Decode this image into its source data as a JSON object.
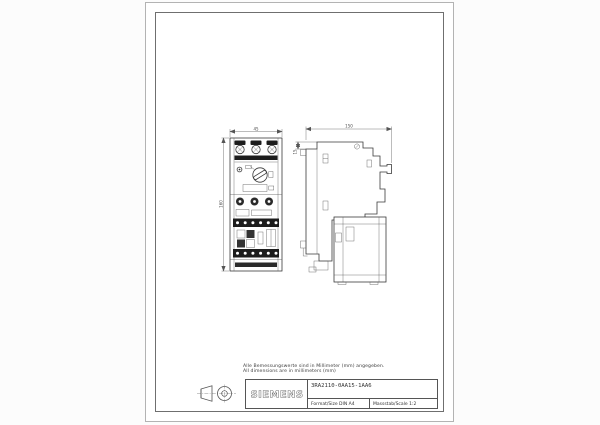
{
  "sheet": {
    "notes": {
      "line1": "Alle Bemessungswerte sind in Millimeter (mm) angegeben.",
      "line2": "All dimensions are in millimeters (mm)"
    },
    "title_block": {
      "brand": "SIEMENS",
      "part_number": "3RA2110-0AA15-1AA6",
      "format": "Format/Size DIN A4",
      "scale": "Massstab/Scale 1:2"
    },
    "dimensions": {
      "front_width": "45",
      "front_height": "160",
      "side_depth": "150",
      "side_offset": "15"
    },
    "icons": {
      "projection": "first-angle-projection-symbol"
    },
    "colors": {
      "line": "#3a3a3a",
      "terminal_black": "#1c1c1c",
      "frame": "#6f6f6f"
    }
  }
}
